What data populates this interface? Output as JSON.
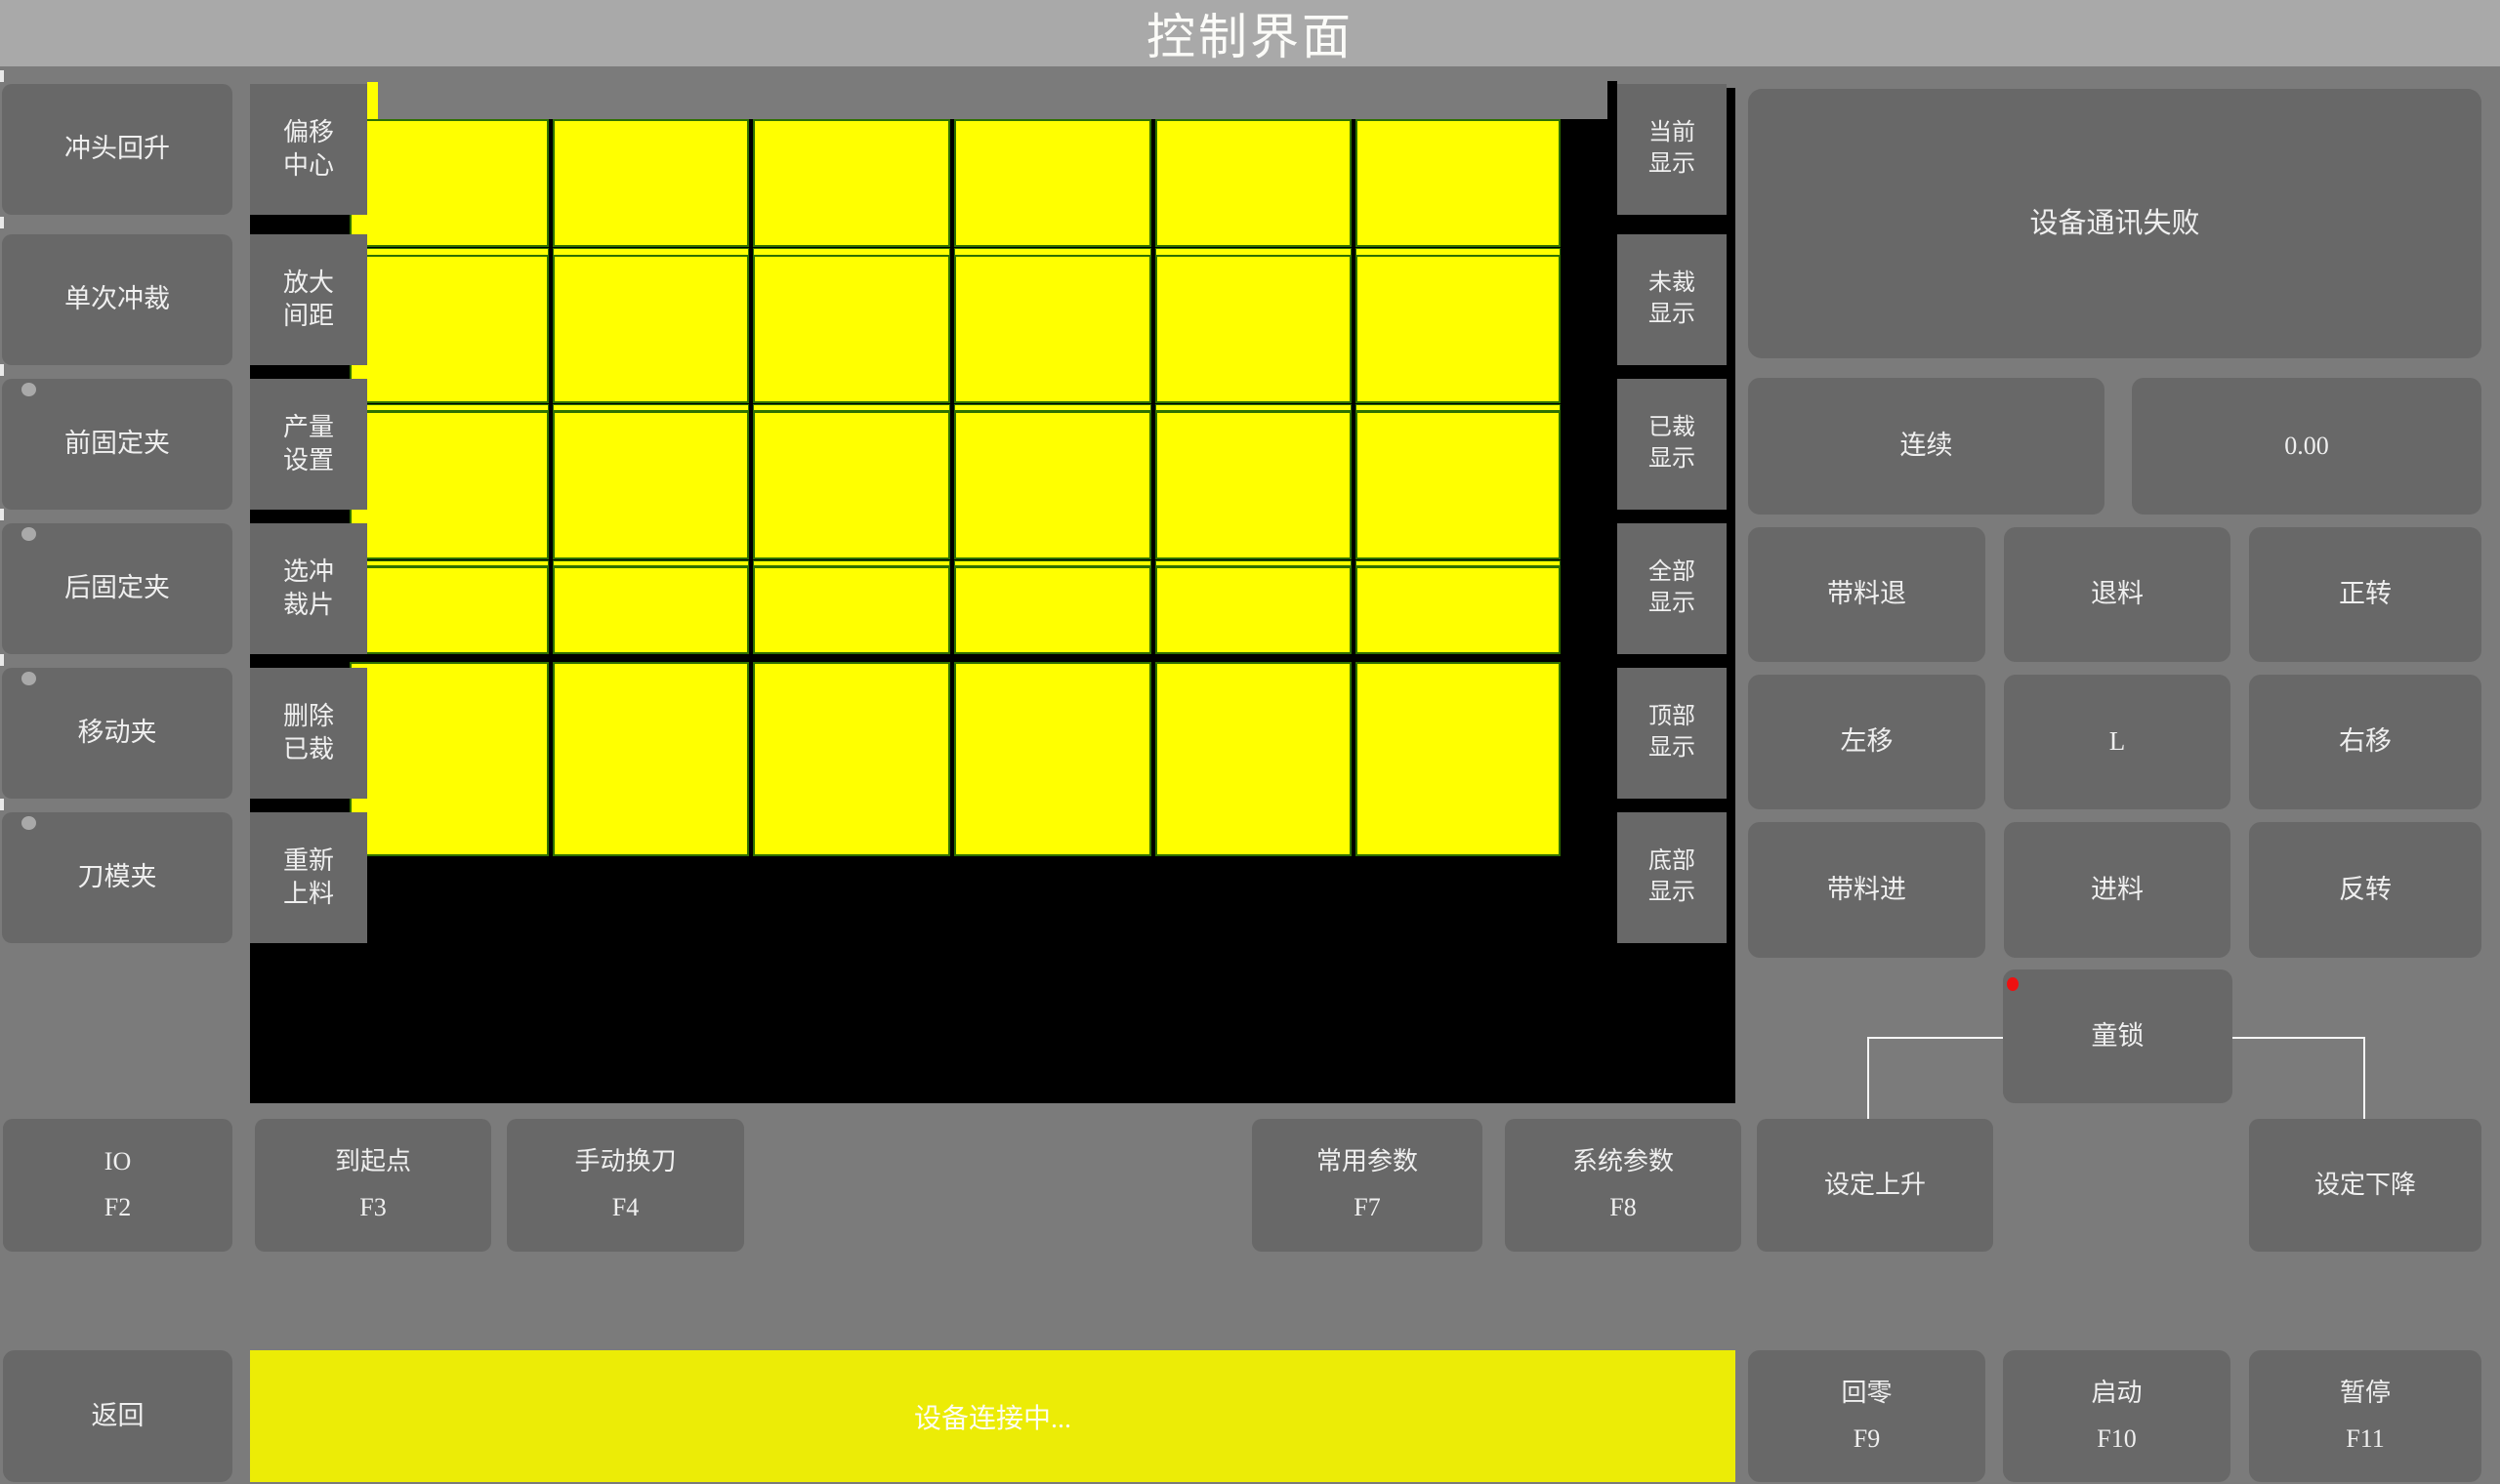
{
  "title": "控制界面",
  "left_col": [
    "冲头回升",
    "单次冲裁",
    "前固定夹",
    "后固定夹",
    "移动夹",
    "刀模夹"
  ],
  "tool_col": [
    "偏移\n中心",
    "放大\n间距",
    "产量\n设置",
    "选冲\n裁片",
    "删除\n已裁",
    "重新\n上料"
  ],
  "display_col": [
    "当前\n显示",
    "未裁\n显示",
    "已裁\n显示",
    "全部\n显示",
    "顶部\n显示",
    "底部\n显示"
  ],
  "panel": {
    "message": "设备通讯失败",
    "continuous": "连续",
    "value": "0.00",
    "grid": [
      [
        "带料退",
        "退料",
        "正转"
      ],
      [
        "左移",
        "L",
        "右移"
      ],
      [
        "带料进",
        "进料",
        "反转"
      ]
    ],
    "child_lock": "童锁"
  },
  "fkeys": [
    "IO\nF2",
    "到起点\nF3",
    "手动换刀\nF4",
    "常用参数\nF7",
    "系统参数\nF8",
    "设定上升",
    "设定下降"
  ],
  "bottom": {
    "back": "返回",
    "status": "设备连接中...",
    "home": "回零\nF9",
    "start": "启动\nF10",
    "pause": "暂停\nF11"
  },
  "canvas": {
    "type": "cut-piece-layout",
    "piece_cols_x": [
      [
        358,
        562
      ],
      [
        566,
        767
      ],
      [
        771,
        973
      ],
      [
        977,
        1179
      ],
      [
        1183,
        1384
      ],
      [
        1388,
        1598
      ]
    ],
    "piece_rows_y": [
      [
        122,
        253
      ],
      [
        261,
        413
      ],
      [
        421,
        573
      ],
      [
        580,
        670
      ],
      [
        678,
        877
      ]
    ],
    "offcut_strips_y": [
      [
        254,
        262
      ],
      [
        414,
        421
      ],
      [
        574,
        580
      ]
    ]
  },
  "colors": {
    "bg": "#7b7b7b",
    "titlebar": "#a9a9a9",
    "button": "#686868",
    "canvas": "#000000",
    "piece": "#ffff00",
    "grid-line": "#2e7000",
    "status-yellow": "#ecec06",
    "text": "#efefef",
    "red-dot": "#ee1111",
    "tick": "#e9e9e9",
    "line-white": "#f5f5f5",
    "dot-gray": "#a9a9a9"
  }
}
